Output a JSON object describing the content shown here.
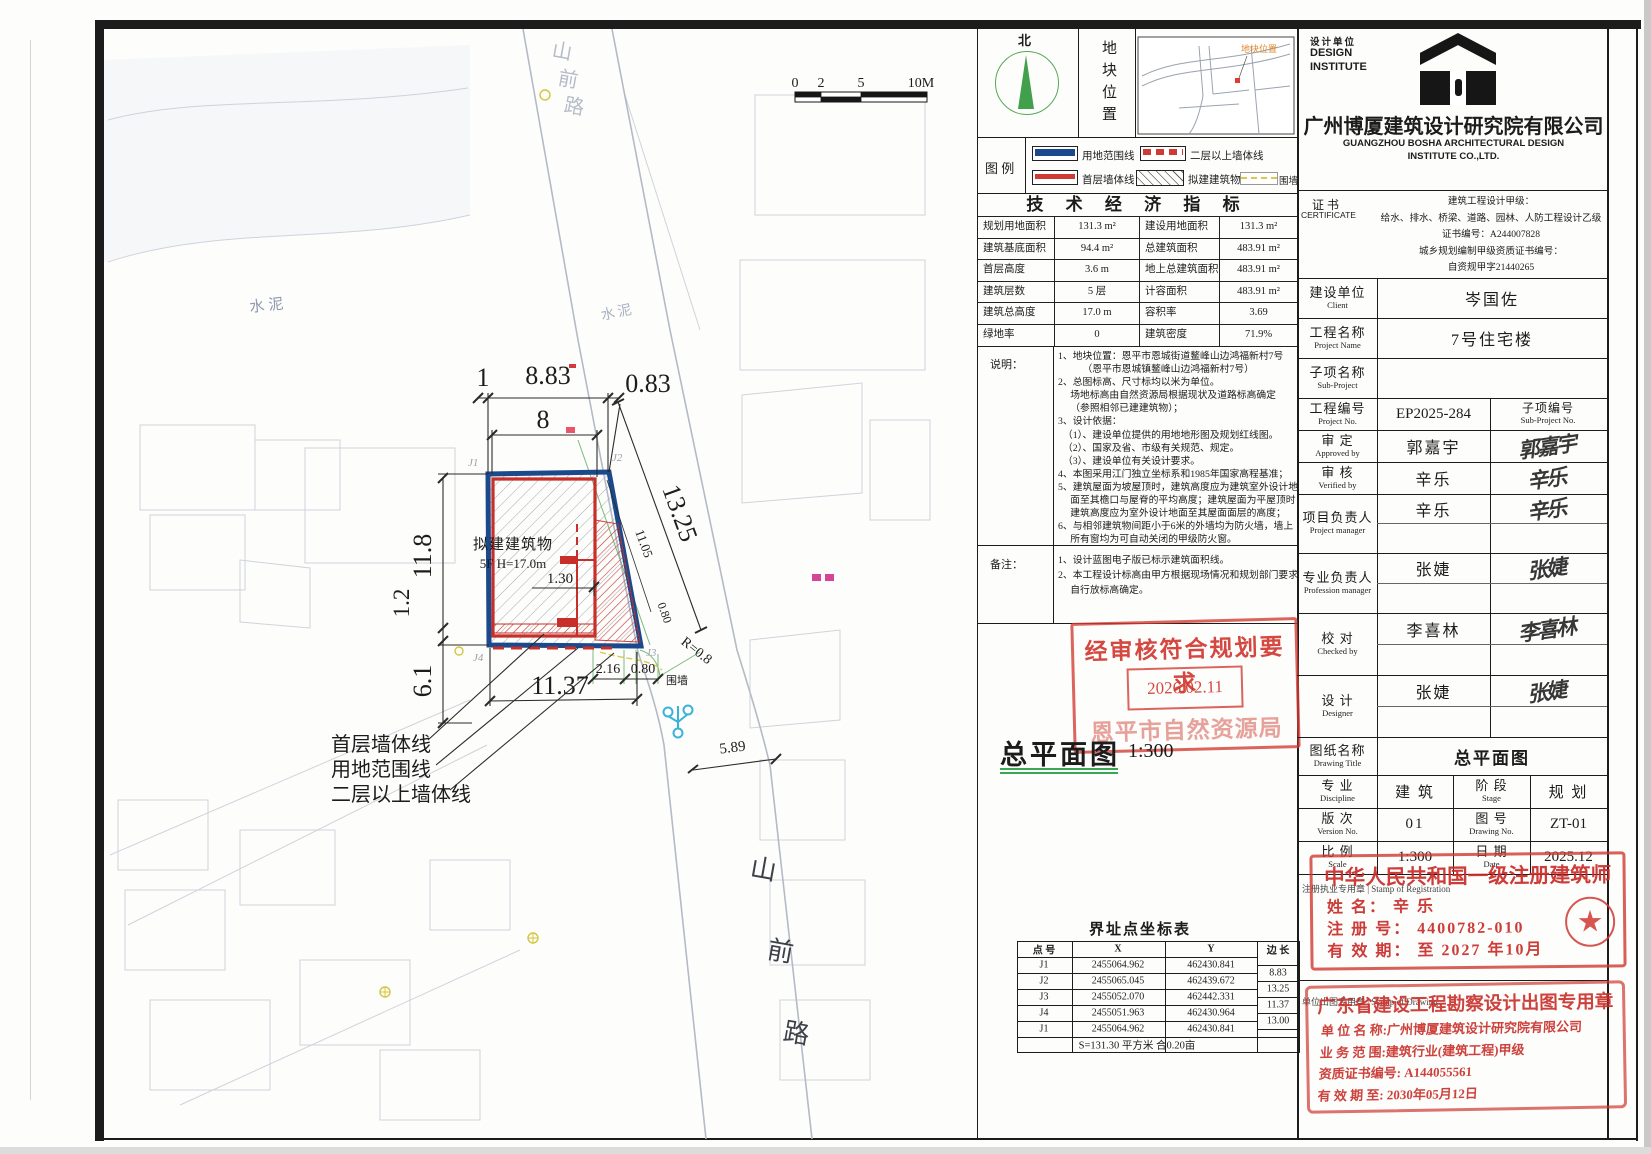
{
  "colors": {
    "boundary_blue": "#1b4a8c",
    "wall_red": "#c62f2a",
    "stamp_red": "#d2443b",
    "fence_yellow": "#d8c94a",
    "survey_green": "#7cba7c",
    "underline_green": "#3aa655"
  },
  "north": {
    "label": "北"
  },
  "site_location": {
    "panel_label": "地块位置",
    "map_label": "地块位置"
  },
  "legend": {
    "title": "图 例",
    "items": [
      {
        "name": "用地范围线"
      },
      {
        "name": "二层以上墙体线"
      },
      {
        "name": "首层墙体线"
      },
      {
        "name": "拟建建筑物"
      },
      {
        "name": "围墙"
      }
    ]
  },
  "indicators": {
    "title": "技 术 经 济 指 标",
    "rows": [
      [
        "规划用地面积",
        "131.3 m²",
        "建设用地面积",
        "131.3 m²"
      ],
      [
        "建筑基底面积",
        "94.4 m²",
        "总建筑面积",
        "483.91 m²"
      ],
      [
        "首层高度",
        "3.6 m",
        "地上总建筑面积",
        "483.91 m²"
      ],
      [
        "建筑层数",
        "5 层",
        "计容面积",
        "483.91 m²"
      ],
      [
        "建筑总高度",
        "17.0 m",
        "容积率",
        "3.69"
      ],
      [
        "绿地率",
        "0",
        "建筑密度",
        "71.9%"
      ]
    ]
  },
  "notes": {
    "label": "说明：",
    "lines": [
      "1、地块位置：恩平市恩城街道鳌峰山边鸿福新村7号",
      "　　　（恩平市恩城镇鳌峰山边鸿福新村7号）",
      "2、总图标高、尺寸标均以米为单位。",
      "　 场地标高由自然资源局根据现状及道路标高确定",
      "　 （参照相邻已建建筑物）；",
      "3、设计依据：",
      "　（1）、建设单位提供的用地地形图及规划红线图。",
      "　（2）、国家及省、市级有关规范、规定。",
      "　（3）、建设单位有关设计要求。",
      "4、本图采用江门独立坐标系和1985年国家高程基准；",
      "5、建筑屋面为坡屋顶时，建筑高度应为建筑室外设计地",
      "　 面至其檐口与屋脊的平均高度；建筑屋面为平屋顶时，",
      "　 建筑高度应为室外设计地面至其屋面面层的高度；",
      "6、与相邻建筑物间距小于6米的外墙均为防火墙，墙上",
      "　 所有窗均为可自动关闭的甲级防火窗。"
    ]
  },
  "remarks": {
    "label": "备注：",
    "lines": [
      "1、设计蓝图电子版已标示建筑面积线。",
      "2、本工程设计标高由甲方根据现场情况和规划部门要求",
      "　 自行放标高确定。"
    ]
  },
  "approval_stamp": {
    "line1": "经审核符合规划要求",
    "date": "2026.02.11",
    "agency": "恩平市自然资源局"
  },
  "plan_title": {
    "text": "总平面图",
    "scale": "1:300"
  },
  "coords": {
    "title": "界址点坐标表",
    "headers": [
      "点 号",
      "X",
      "Y",
      "边 长"
    ],
    "rows": [
      [
        "J1",
        "2455064.962",
        "462430.841"
      ],
      [
        "J2",
        "2455065.045",
        "462439.672"
      ],
      [
        "J3",
        "2455052.070",
        "462442.331"
      ],
      [
        "J4",
        "2455051.963",
        "462430.964"
      ],
      [
        "J1",
        "2455064.962",
        "462430.841"
      ]
    ],
    "edges": [
      "8.83",
      "13.25",
      "11.37",
      "13.00"
    ],
    "footer": "S=131.30 平方米 合0.20亩"
  },
  "titleblock": {
    "design_unit_cn": "设计单位",
    "design_unit_en1": "DESIGN",
    "design_unit_en2": "INSTITUTE",
    "company_cn": "广州博厦建筑设计研究院有限公司",
    "company_en1": "GUANGZHOU BOSHA ARCHITECTURAL DESIGN",
    "company_en2": "INSTITUTE CO.,LTD.",
    "cert_label_cn": "证 书",
    "cert_label_en": "CERTIFICATE",
    "cert_lines": [
      "建筑工程设计甲级：",
      "给水、排水、桥梁、道路、园林、人防工程设计乙级",
      "证书编号：A244007828",
      "城乡规划编制甲级资质证书编号：",
      "自资规甲字21440265"
    ],
    "rows": [
      {
        "label_cn": "建设单位",
        "label_en": "Client",
        "value": "岑国佐"
      },
      {
        "label_cn": "工程名称",
        "label_en": "Project Name",
        "value": "7号住宅楼"
      },
      {
        "label_cn": "子项名称",
        "label_en": "Sub-Project",
        "value": ""
      },
      {
        "label_cn": "工程编号",
        "label_en": "Project No.",
        "value": "EP2025-284",
        "extra_cn": "子项编号",
        "extra_en": "Sub-Project No."
      },
      {
        "label_cn": "审  定",
        "label_en": "Approved by",
        "value": "郭嘉宇",
        "sig": "郭嘉宇"
      },
      {
        "label_cn": "审  核",
        "label_en": "Verified by",
        "value": "辛乐",
        "sig": "辛乐"
      },
      {
        "label_cn": "项目负责人",
        "label_en": "Project manager",
        "value": "辛乐",
        "sig": "辛乐"
      },
      {
        "label_cn": "专业负责人",
        "label_en": "Profession manager",
        "value": "张婕",
        "sig": "张婕"
      },
      {
        "label_cn": "校  对",
        "label_en": "Checked by",
        "value": "李喜林",
        "sig": "李喜林"
      },
      {
        "label_cn": "设  计",
        "label_en": "Designer",
        "value": "张婕",
        "sig": "张婕"
      },
      {
        "label_cn": "图纸名称",
        "label_en": "Drawing Title",
        "value": "总平面图"
      }
    ],
    "meta": {
      "discipline_label_cn": "专  业",
      "discipline_label_en": "Discipline",
      "discipline": "建 筑",
      "stage_label_cn": "阶  段",
      "stage_label_en": "Stage",
      "stage": "规 划",
      "version_label_cn": "版  次",
      "version_label_en": "Version No.",
      "version": "01",
      "dwgno_label_cn": "图  号",
      "dwgno_label_en": "Drawing No.",
      "dwgno": "ZT-01",
      "scale_label_cn": "比  例",
      "scale_label_en": "Scale",
      "scale": "1:300",
      "date_label_cn": "日  期",
      "date_label_en": "Date",
      "date": "2025.12"
    }
  },
  "arch_stamp": {
    "black_label": "注册执业专用章 | Stamp of Registration",
    "title": "中华人民共和国一级注册建筑师",
    "name_row": "姓  名：  辛  乐",
    "reg_row": "注 册 号：  4400782-010",
    "valid_row": "有 效 期：  至 2027 年10月"
  },
  "inst_stamp": {
    "black_label": "单位出图专用章 | Stamp of Drawing",
    "title": "广东省建设工程勘察设计出图专用章",
    "lines": [
      "单 位 名 称:广州博厦建筑设计研究院有限公司",
      "业 务 范 围:建筑行业(建筑工程)甲级",
      "资质证书编号: A144055561",
      "有 效 期 至: 2030年05月12日"
    ]
  },
  "site": {
    "scale_ticks": [
      "0",
      "2",
      "5",
      "10M"
    ],
    "road_name": [
      "山",
      "前",
      "路"
    ],
    "cement": "水泥",
    "building_line1": "拟建建筑物",
    "building_line2": "5F  H=17.0m",
    "dims": {
      "top_small": "1",
      "top": "8.83",
      "top_right": "0.83",
      "top2": "8",
      "left": "11.8",
      "left_small": "1.2",
      "left_lower": "6.1",
      "right": "13.25",
      "right_inner": "11.05",
      "right_small": "0.80",
      "inner": "1.30",
      "bottom_a": "2.16",
      "bottom_b": "0.80",
      "bottom": "11.37",
      "radius": "R=0.8",
      "road_width": "5.89"
    },
    "points": {
      "j1": "J1",
      "j2": "J2",
      "j3": "J3",
      "j4": "J4"
    },
    "leaders": {
      "wall1": "首层墙体线",
      "boundary": "用地范围线",
      "wall2": "二层以上墙体线",
      "fence": "围墙"
    }
  }
}
